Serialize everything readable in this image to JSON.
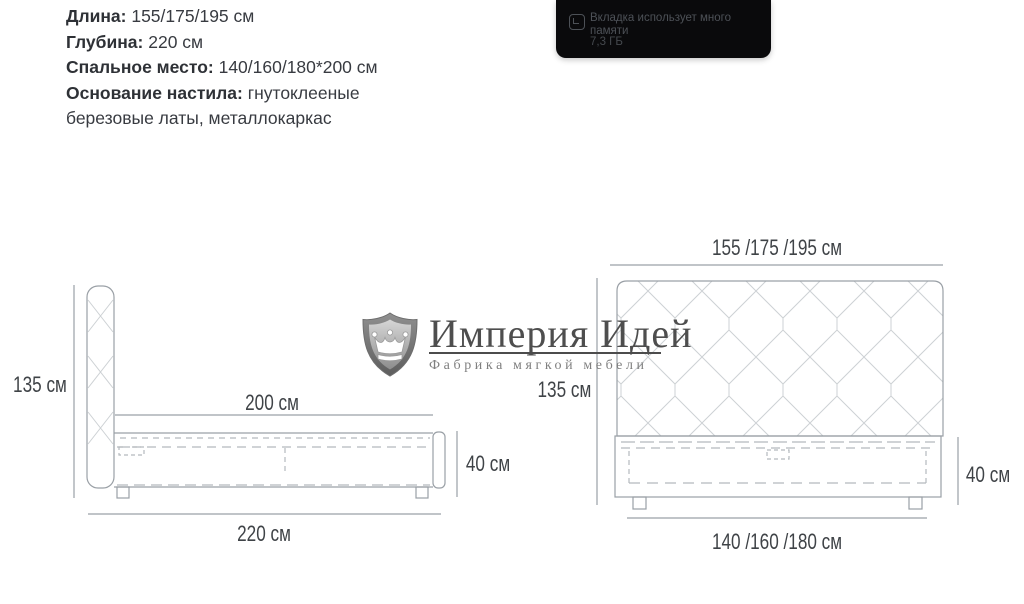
{
  "specs": {
    "lines": [
      {
        "label": "Длина:",
        "value": " 155/175/195 см"
      },
      {
        "label": "Глубина:",
        "value": " 220 см"
      },
      {
        "label": "Спальное место:",
        "value": " 140/160/180*200 см"
      },
      {
        "label": "Основание настила:",
        "value": " гнутоклееные"
      },
      {
        "label": "",
        "value": "березовые латы, металлокаркас"
      }
    ]
  },
  "browser_popup": {
    "icon": "memory-gauge-icon",
    "message": "Вкладка использует много памяти",
    "memory": "7,3 ГБ",
    "background": "#0a0a0c",
    "text_color": "#4d5157"
  },
  "watermark": {
    "logo_icon": "shield-crown-icon",
    "title": "Империя Идей",
    "subtitle": "Фабрика мягкой мебели",
    "title_color": "#4e4e4e",
    "subtitle_color": "#7f7f7f"
  },
  "diagrams": {
    "line_color": "#9aa0a6",
    "dash_color": "#b4b9bd",
    "pattern_color": "#cdd1d4",
    "dim_text_color": "#3f4347",
    "side_view": {
      "height": "135 см",
      "sleep_length": "200 см",
      "base_height": "40 см",
      "total_length": "220 см"
    },
    "front_view": {
      "width": "155 /175 /195  см",
      "height": "135 см",
      "base_height": "40 см",
      "sleep_width": "140 /160 /180 см"
    }
  }
}
